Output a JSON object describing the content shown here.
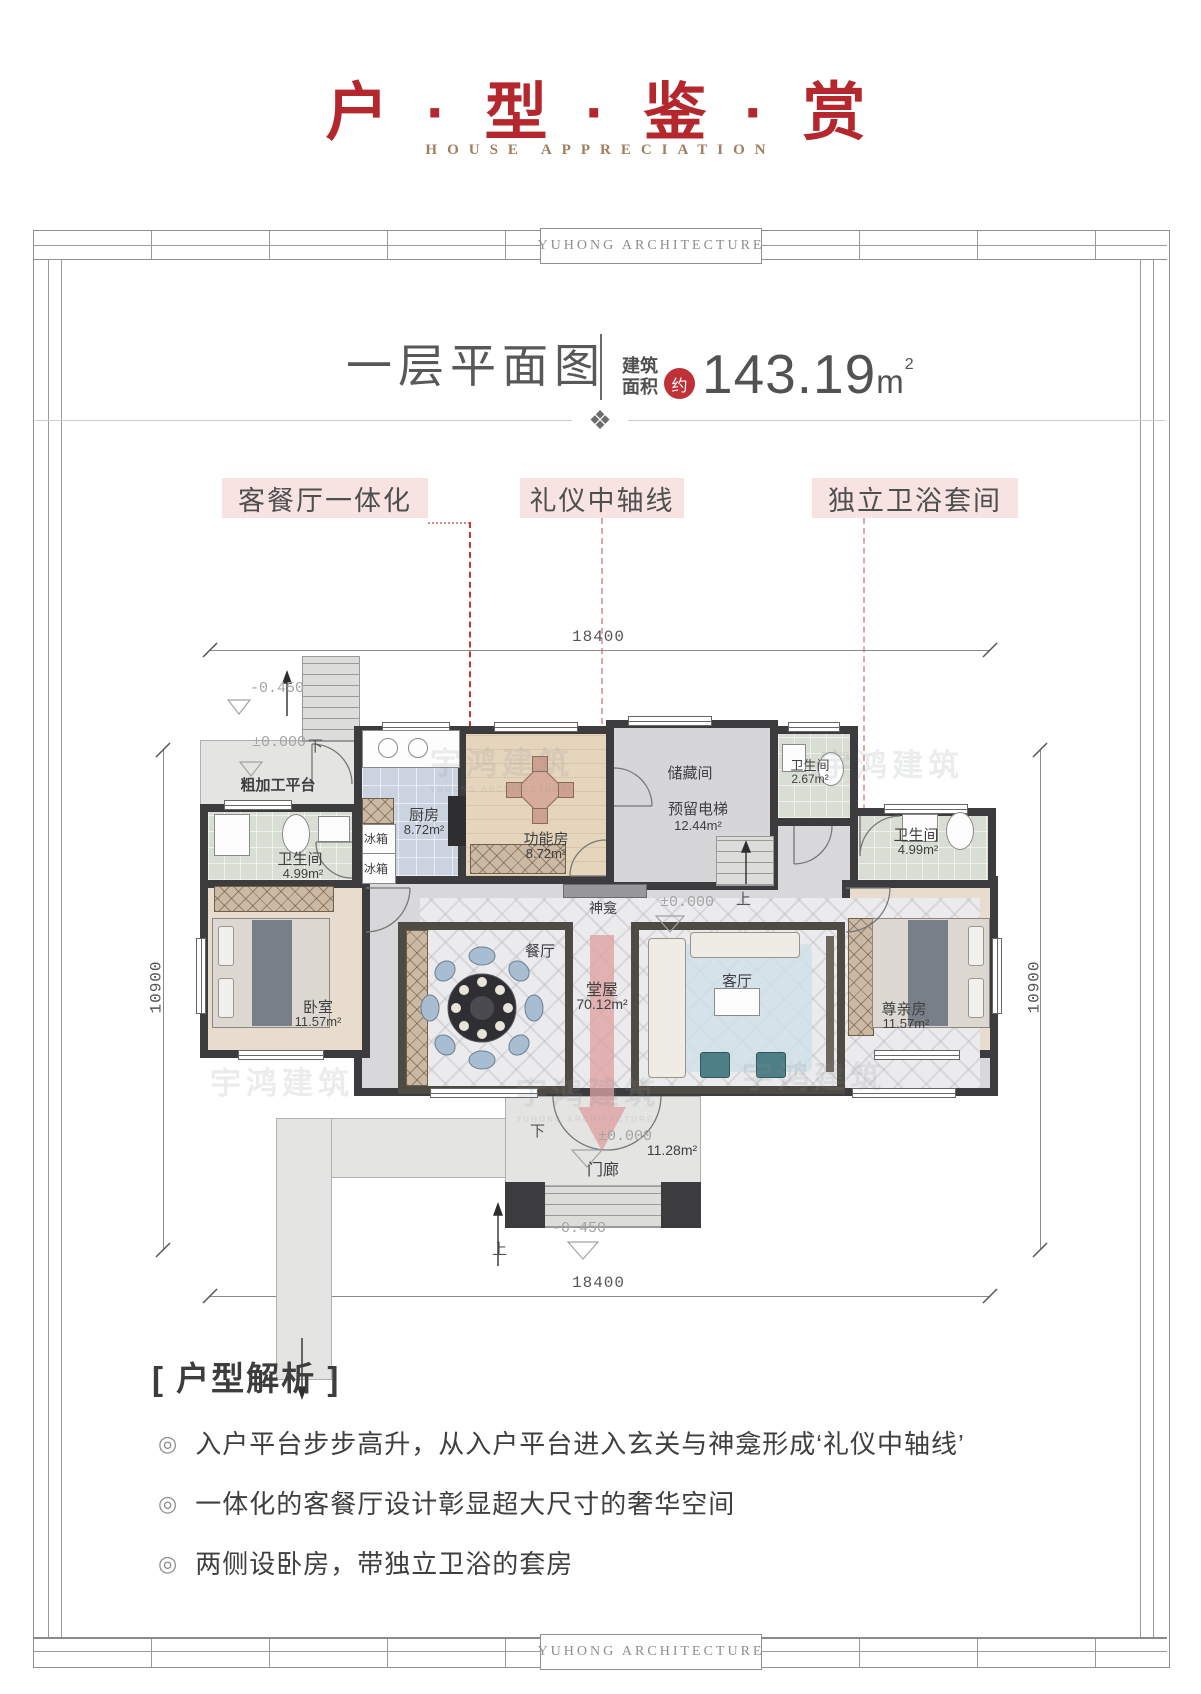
{
  "page": {
    "title": "户 · 型 · 鉴 · 赏",
    "subtitle": "HOUSE APPRECIATION",
    "brand": "YUHONG  ARCHITECTURE",
    "ornament": "❖"
  },
  "plan_header": {
    "title": "一层平面图",
    "area_label_line1": "建筑",
    "area_label_line2": "面积",
    "approx_badge": "约",
    "area_value": "143.19",
    "area_unit": "m",
    "area_sup": "2"
  },
  "callouts": [
    {
      "label": "客餐厅一体化"
    },
    {
      "label": "礼仪中轴线"
    },
    {
      "label": "独立卫浴套间"
    }
  ],
  "dimensions": {
    "top": "18400",
    "bottom": "18400",
    "left": "10900",
    "right": "10900"
  },
  "floor_plan": {
    "platform": {
      "name": "粗加工平台"
    },
    "bath_left": {
      "name": "卫生间",
      "area": "4.99m²"
    },
    "bedroom_left": {
      "name": "卧室",
      "area": "11.57m²"
    },
    "kitchen": {
      "name": "厨房",
      "area": "8.72m²"
    },
    "fridge": "冰箱",
    "function_room": {
      "name": "功能房",
      "area": "8.72m²"
    },
    "storage": {
      "name": "储藏间"
    },
    "elevator": {
      "name": "预留电梯",
      "area": "12.44m²"
    },
    "bath_small": {
      "name": "卫生间",
      "area": "2.67m²"
    },
    "bath_right": {
      "name": "卫生间",
      "area": "4.99m²"
    },
    "elder_room": {
      "name": "尊亲房",
      "area": "11.57m²"
    },
    "dining": {
      "name": "餐厅"
    },
    "hall": {
      "name": "堂屋",
      "area": "70.12m²"
    },
    "living": {
      "name": "客厅"
    },
    "shrine": {
      "name": "神龛"
    },
    "porch": {
      "name": "门廊",
      "area": "11.28m²"
    },
    "marks": {
      "zero": "±0.000",
      "minus": "-0.450",
      "down": "下",
      "up": "上"
    }
  },
  "watermark": {
    "cn": "宇鸿建筑",
    "en": "YUHONG ARCHITECTURE"
  },
  "analysis": {
    "heading": "[ 户型解析 ]",
    "bullet_mark": "◎",
    "bullets": [
      "入户平台步步高升，从入户平台进入玄关与神龛形成‘礼仪中轴线’",
      "一体化的客餐厅设计彰显超大尺寸的奢华空间",
      "两侧设卧房，带独立卫浴的套房"
    ]
  },
  "colors": {
    "title_red": "#b4282d",
    "subtitle_gold": "#a07d5f",
    "badge_red": "#bf3137",
    "callout_pink": "#f8e3e3",
    "accent_red": "#c2141c",
    "axis_arrow_pink": "#dfa2a2",
    "wall_dark": "#3c3c3e"
  }
}
